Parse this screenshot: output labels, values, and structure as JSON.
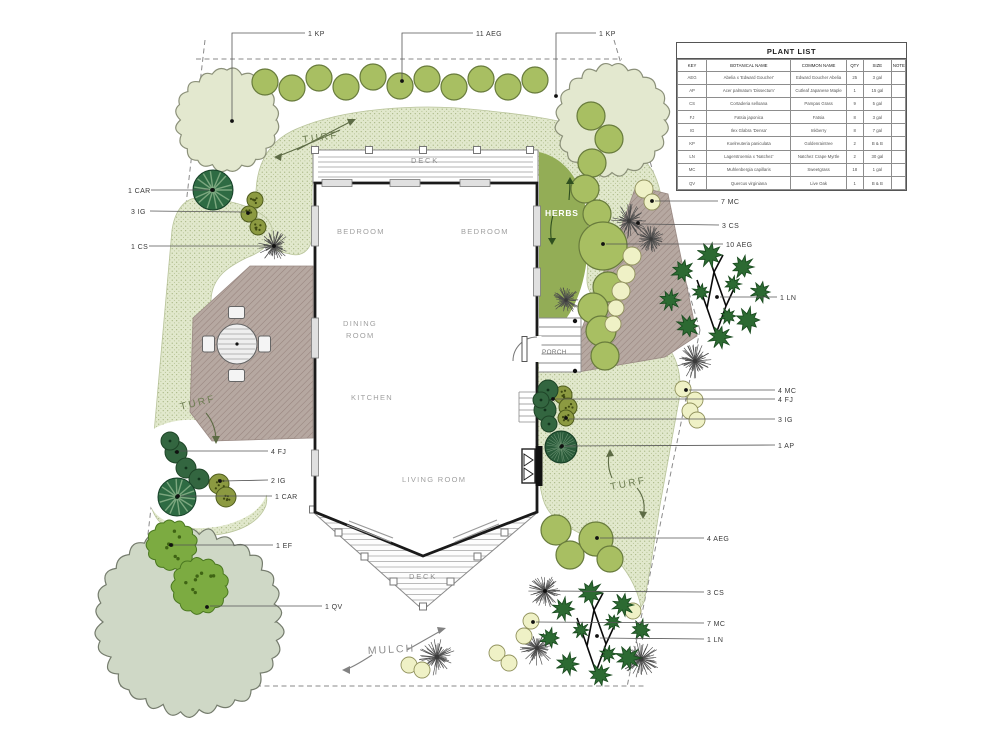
{
  "plant_list": {
    "title": "PLANT LIST",
    "columns": [
      "KEY",
      "BOTANICAL NAME",
      "COMMON NAME",
      "QTY",
      "SIZE",
      "NOTE"
    ],
    "rows": [
      [
        "AEG",
        "Abelia x 'Edward Goucher'",
        "Edward Goucher Abelia",
        "25",
        "3 gal",
        ""
      ],
      [
        "AP",
        "Acer palmatum 'Dissectum'",
        "Cutleaf Japanese Maple",
        "1",
        "15 gal",
        ""
      ],
      [
        "CS",
        "Cortaderia selloana",
        "Pampas Grass",
        "9",
        "5 gal",
        ""
      ],
      [
        "FJ",
        "Fatsia japonica",
        "Fatsia",
        "8",
        "3 gal",
        ""
      ],
      [
        "IG",
        "Ilex Glabra 'Densa'",
        "Inkberry",
        "8",
        "7 gal",
        ""
      ],
      [
        "KP",
        "Koelreuteria paniculata",
        "Goldenraintree",
        "2",
        "B & B",
        ""
      ],
      [
        "LN",
        "Lagerstroemia x 'Natchez'",
        "Natchez Crape Myrtle",
        "2",
        "30 gal",
        ""
      ],
      [
        "MC",
        "Muhlenbergia capillaris",
        "Sweetgrass",
        "18",
        "1 gal",
        ""
      ],
      [
        "QV",
        "Quercus virginiana",
        "Live Oak",
        "1",
        "B & B",
        ""
      ]
    ]
  },
  "rooms": {
    "bedroom1": "BEDROOM",
    "bedroom2": "BEDROOM",
    "dining1": "DINING",
    "dining2": "ROOM",
    "kitchen": "KITCHEN",
    "living": "LIVING ROOM",
    "deck_top": "DECK",
    "deck_bottom": "DECK",
    "porch": "PORCH"
  },
  "area_labels": [
    {
      "text": "TURF",
      "x": 303,
      "y": 143,
      "rot": -8,
      "fs": 10,
      "ls": 2.5,
      "col": "#6e7e53"
    },
    {
      "text": "TURF",
      "x": 181,
      "y": 410,
      "rot": -14,
      "fs": 10,
      "ls": 2.5,
      "col": "#6e7e53"
    },
    {
      "text": "TURF",
      "x": 611,
      "y": 490,
      "rot": -11,
      "fs": 10,
      "ls": 2.5,
      "col": "#6e7e53"
    },
    {
      "text": "MULCH",
      "x": 368,
      "y": 654,
      "rot": -3,
      "fs": 10.5,
      "ls": 2,
      "col": "#8d8d8d"
    },
    {
      "text": "HERBS",
      "x": 545,
      "y": 216,
      "rot": 0,
      "fs": 8.5,
      "ls": 0.8,
      "col": "#ffffff",
      "bold": true
    },
    {
      "text": "DECK",
      "x": 411,
      "y": 163,
      "rot": 0,
      "fs": 7.5,
      "ls": 1.8,
      "col": "#8f8f8f"
    },
    {
      "text": "DECK",
      "x": 409,
      "y": 579,
      "rot": 0,
      "fs": 7.5,
      "ls": 1.8,
      "col": "#8f8f8f"
    },
    {
      "text": "PORCH",
      "x": 542,
      "y": 354,
      "rot": 0,
      "fs": 6.3,
      "ls": 0.4,
      "col": "#6f6f6f"
    },
    {
      "text": "BEDROOM",
      "x": 337,
      "y": 234,
      "rot": 0,
      "fs": 7.5,
      "ls": 1.3,
      "col": "#a0a0a0"
    },
    {
      "text": "BEDROOM",
      "x": 461,
      "y": 234,
      "rot": 0,
      "fs": 7.5,
      "ls": 1.3,
      "col": "#a0a0a0"
    },
    {
      "text": "DINING",
      "x": 343,
      "y": 326,
      "rot": 0,
      "fs": 7.5,
      "ls": 1.3,
      "col": "#a0a0a0"
    },
    {
      "text": "ROOM",
      "x": 346,
      "y": 338,
      "rot": 0,
      "fs": 7.5,
      "ls": 1.3,
      "col": "#a0a0a0"
    },
    {
      "text": "KITCHEN",
      "x": 351,
      "y": 400,
      "rot": 0,
      "fs": 7.5,
      "ls": 1.3,
      "col": "#a0a0a0"
    },
    {
      "text": "LIVING ROOM",
      "x": 402,
      "y": 482,
      "rot": 0,
      "fs": 7.5,
      "ls": 1.3,
      "col": "#a0a0a0"
    }
  ],
  "plant_labels": [
    {
      "text": "1 KP",
      "tx": 308,
      "ty": 36,
      "pts": [
        [
          305,
          33
        ],
        [
          232,
          33
        ],
        [
          232,
          119
        ]
      ],
      "dot": [
        232,
        121
      ]
    },
    {
      "text": "11 AEG",
      "tx": 476,
      "ty": 36,
      "pts": [
        [
          473,
          33
        ],
        [
          402,
          33
        ],
        [
          402,
          79
        ]
      ],
      "dot": [
        402,
        81
      ]
    },
    {
      "text": "1 KP",
      "tx": 599,
      "ty": 36,
      "pts": [
        [
          596,
          33
        ],
        [
          556,
          33
        ],
        [
          556,
          94
        ]
      ],
      "dot": [
        556,
        96
      ]
    },
    {
      "text": "1 CAR",
      "tx": 128,
      "ty": 193,
      "pts": [
        [
          151,
          190
        ],
        [
          209,
          190
        ]
      ],
      "dot": [
        212,
        190
      ]
    },
    {
      "text": "3 IG",
      "tx": 131,
      "ty": 214,
      "pts": [
        [
          150,
          211
        ],
        [
          245,
          212
        ]
      ],
      "dot": [
        248,
        213
      ]
    },
    {
      "text": "1 CS",
      "tx": 131,
      "ty": 249,
      "pts": [
        [
          149,
          246
        ],
        [
          271,
          246
        ]
      ],
      "dot": [
        274,
        246
      ]
    },
    {
      "text": "4 FJ",
      "tx": 271,
      "ty": 454,
      "pts": [
        [
          268,
          451
        ],
        [
          180,
          451
        ]
      ],
      "dot": [
        177,
        452
      ]
    },
    {
      "text": "2 IG",
      "tx": 271,
      "ty": 483,
      "pts": [
        [
          268,
          480
        ],
        [
          223,
          481
        ]
      ],
      "dot": [
        220,
        481
      ]
    },
    {
      "text": "1 CAR",
      "tx": 275,
      "ty": 499,
      "pts": [
        [
          272,
          496
        ],
        [
          181,
          496
        ]
      ],
      "dot": [
        178,
        496
      ]
    },
    {
      "text": "1 EF",
      "tx": 276,
      "ty": 548,
      "pts": [
        [
          273,
          545
        ],
        [
          174,
          545
        ]
      ],
      "dot": [
        171,
        545
      ]
    },
    {
      "text": "1 QV",
      "tx": 325,
      "ty": 609,
      "pts": [
        [
          322,
          606
        ],
        [
          210,
          606
        ]
      ],
      "dot": [
        207,
        607
      ]
    },
    {
      "text": "7 MC",
      "tx": 721,
      "ty": 204,
      "pts": [
        [
          718,
          201
        ],
        [
          655,
          201
        ]
      ],
      "dot": [
        652,
        201
      ]
    },
    {
      "text": "3 CS",
      "tx": 722,
      "ty": 228,
      "pts": [
        [
          719,
          225
        ],
        [
          641,
          224
        ]
      ],
      "dot": [
        638,
        223
      ]
    },
    {
      "text": "10 AEG",
      "tx": 726,
      "ty": 247,
      "pts": [
        [
          723,
          244
        ],
        [
          606,
          244
        ]
      ],
      "dot": [
        603,
        244
      ]
    },
    {
      "text": "1 LN",
      "tx": 780,
      "ty": 300,
      "pts": [
        [
          777,
          297
        ],
        [
          720,
          297
        ]
      ],
      "dot": [
        717,
        297
      ]
    },
    {
      "text": "4 MC",
      "tx": 778,
      "ty": 393,
      "pts": [
        [
          775,
          390
        ],
        [
          689,
          390
        ]
      ],
      "dot": [
        686,
        390
      ]
    },
    {
      "text": "4 FJ",
      "tx": 778,
      "ty": 402,
      "pts": [
        [
          775,
          399
        ],
        [
          556,
          399
        ]
      ],
      "dot": [
        553,
        399
      ]
    },
    {
      "text": "3 IG",
      "tx": 778,
      "ty": 422,
      "pts": [
        [
          775,
          419
        ],
        [
          569,
          419
        ]
      ],
      "dot": [
        566,
        418
      ]
    },
    {
      "text": "1 AP",
      "tx": 778,
      "ty": 448,
      "pts": [
        [
          775,
          445
        ],
        [
          565,
          446
        ]
      ],
      "dot": [
        562,
        446
      ]
    },
    {
      "text": "4 AEG",
      "tx": 707,
      "ty": 541,
      "pts": [
        [
          704,
          538
        ],
        [
          600,
          538
        ]
      ],
      "dot": [
        597,
        538
      ]
    },
    {
      "text": "3 CS",
      "tx": 707,
      "ty": 595,
      "pts": [
        [
          704,
          592
        ],
        [
          548,
          591
        ]
      ],
      "dot": [
        545,
        591
      ]
    },
    {
      "text": "7 MC",
      "tx": 707,
      "ty": 626,
      "pts": [
        [
          704,
          623
        ],
        [
          536,
          622
        ]
      ],
      "dot": [
        533,
        622
      ]
    },
    {
      "text": "1 LN",
      "tx": 707,
      "ty": 642,
      "pts": [
        [
          704,
          639
        ],
        [
          600,
          638
        ]
      ],
      "dot": [
        597,
        636
      ]
    }
  ],
  "arrows": [
    {
      "d": "M340,130 Q300,148 276,157",
      "head": "274,157 282,153 281,161",
      "col": "#5d6b45"
    },
    {
      "d": "M297,150 Q330,132 354,120",
      "head": "356,119 347,119 350,126",
      "col": "#5d6b45"
    },
    {
      "d": "M206,413 Q216,425 216,441",
      "head": "216,444 212,436 220,436",
      "col": "#5d6b45"
    },
    {
      "d": "M612,478 Q606,464 610,451",
      "head": "610,449 606,457 614,456",
      "col": "#5d6b45"
    },
    {
      "d": "M637,488 Q647,500 643,517",
      "head": "643,519 639,511 647,512",
      "col": "#5d6b45"
    },
    {
      "d": "M569,200 Q570,190 570,179",
      "head": "570,177 566,184 574,184",
      "col": "#2f4f1f"
    },
    {
      "d": "M553,215 Q549,230 552,243",
      "head": "552,245 548,238 556,238",
      "col": "#2f4f1f"
    },
    {
      "d": "M407,650 Q428,638 444,629",
      "head": "446,628 437,627 439,634",
      "col": "#828282"
    },
    {
      "d": "M372,655 Q352,668 344,670",
      "head": "342,670 350,666 350,674",
      "col": "#828282"
    }
  ],
  "plants": {
    "kp": [
      [
        227,
        120,
        50
      ],
      [
        612,
        120,
        55
      ]
    ],
    "qv": [
      [
        190,
        622,
        92
      ]
    ],
    "ef": [
      [
        172,
        545,
        24
      ],
      [
        200,
        586,
        27
      ]
    ],
    "aeg": [
      [
        265,
        82,
        13
      ],
      [
        292,
        88,
        13
      ],
      [
        319,
        78,
        13
      ],
      [
        346,
        87,
        13
      ],
      [
        373,
        77,
        13
      ],
      [
        400,
        86,
        13
      ],
      [
        427,
        79,
        13
      ],
      [
        454,
        87,
        13
      ],
      [
        481,
        79,
        13
      ],
      [
        508,
        87,
        13
      ],
      [
        535,
        80,
        13
      ],
      [
        591,
        116,
        14
      ],
      [
        609,
        139,
        14
      ],
      [
        592,
        163,
        14
      ],
      [
        585,
        189,
        14
      ],
      [
        597,
        214,
        14
      ],
      [
        603,
        246,
        24
      ],
      [
        608,
        287,
        15
      ],
      [
        593,
        308,
        15
      ],
      [
        601,
        331,
        15
      ],
      [
        605,
        356,
        14
      ],
      [
        556,
        530,
        15
      ],
      [
        570,
        555,
        14
      ],
      [
        596,
        539,
        17
      ],
      [
        610,
        559,
        13
      ]
    ],
    "mc": [
      [
        644,
        189,
        9
      ],
      [
        652,
        202,
        8
      ],
      [
        632,
        256,
        9
      ],
      [
        626,
        274,
        9
      ],
      [
        621,
        291,
        9
      ],
      [
        616,
        308,
        8
      ],
      [
        613,
        324,
        8
      ],
      [
        683,
        389,
        8
      ],
      [
        695,
        400,
        8
      ],
      [
        690,
        411,
        8
      ],
      [
        697,
        420,
        8
      ],
      [
        633,
        611,
        8
      ],
      [
        531,
        621,
        8
      ],
      [
        524,
        636,
        8
      ],
      [
        497,
        653,
        8
      ],
      [
        509,
        663,
        8
      ],
      [
        409,
        665,
        8
      ],
      [
        422,
        670,
        8
      ]
    ],
    "ig": [
      [
        255,
        200,
        8
      ],
      [
        249,
        214,
        8
      ],
      [
        258,
        227,
        8
      ],
      [
        219,
        484,
        10
      ],
      [
        226,
        497,
        10
      ],
      [
        563,
        395,
        9
      ],
      [
        568,
        407,
        9
      ],
      [
        566,
        418,
        8
      ]
    ],
    "fj": [
      [
        176,
        452,
        11
      ],
      [
        186,
        468,
        10
      ],
      [
        199,
        479,
        10
      ],
      [
        170,
        441,
        9
      ],
      [
        548,
        390,
        10
      ],
      [
        545,
        410,
        11
      ],
      [
        549,
        424,
        8
      ],
      [
        541,
        400,
        8
      ]
    ],
    "car": [
      [
        213,
        190,
        20
      ],
      [
        177,
        497,
        19
      ]
    ],
    "cs": [
      [
        274,
        246,
        16
      ],
      [
        629,
        221,
        18
      ],
      [
        651,
        239,
        14
      ],
      [
        695,
        361,
        18
      ],
      [
        566,
        300,
        14
      ],
      [
        545,
        591,
        17
      ],
      [
        537,
        648,
        18
      ],
      [
        437,
        657,
        19
      ],
      [
        641,
        659,
        19
      ]
    ],
    "ap": [
      [
        561,
        447,
        16
      ]
    ],
    "ln": [
      [
        716,
        296
      ],
      [
        596,
        634
      ]
    ]
  },
  "colors": {
    "turf_bg": "#e1e8cc",
    "turf_dot": "#93a46a",
    "paving": "#b6a8a1",
    "paving_line": "#97847e",
    "wall": "#1a1a1a",
    "herbs_bed": "#93ad56",
    "kp_fill": "#e3e8cf",
    "kp_stroke": "#8b9079",
    "qv_fill": "#cfd8c6",
    "qv_stroke": "#757c6d",
    "ef_fill": "#7cab41",
    "ef_stroke": "#4a7720",
    "aeg_fill": "#a8bf62",
    "aeg_stroke": "#687b3c",
    "mc_fill": "#eff1c6",
    "mc_stroke": "#90915c",
    "ig_fill": "#8c9a41",
    "ig_stroke": "#4f5c1d",
    "fj_fill": "#336640",
    "fj_stroke": "#1e4427",
    "car_fill": "#2e6b43",
    "car_ray": "#7ca77f",
    "ap_fill": "#2a5b3a",
    "ap_ray": "#6e9574",
    "cs_line": "#4d4d4d",
    "ln_leaf": "#2c6a32",
    "ln_branch": "#0a0a0a",
    "leader": "#555555",
    "label_text": "#3a3a3a",
    "boundary": "#8a8a8a"
  }
}
